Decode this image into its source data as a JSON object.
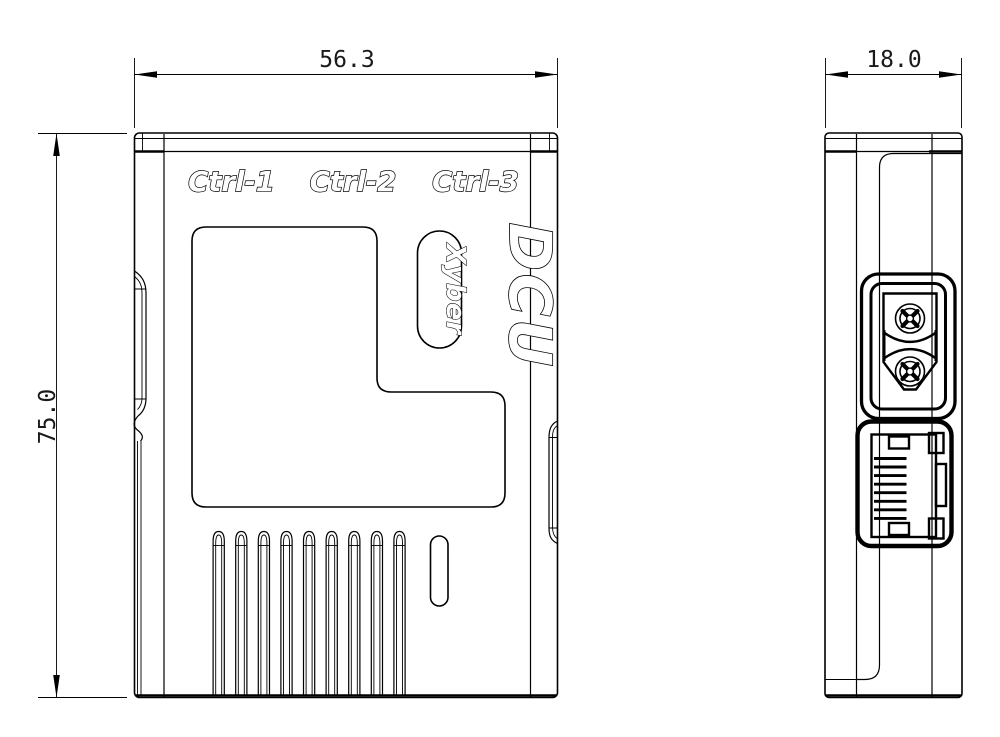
{
  "page": {
    "background": "#ffffff",
    "line_color": "#000000"
  },
  "front_view": {
    "width_dimension": "56.3",
    "height_dimension": "75.0",
    "port_labels": [
      "Ctrl-1",
      "Ctrl-2",
      "Ctrl-3"
    ],
    "product_name": "DCU",
    "brand_badge": "Xyber",
    "vent_slot_count": 9
  },
  "side_view": {
    "depth_dimension": "18.0",
    "features": [
      "xt30-power-connector",
      "rj45-ethernet-port"
    ]
  }
}
